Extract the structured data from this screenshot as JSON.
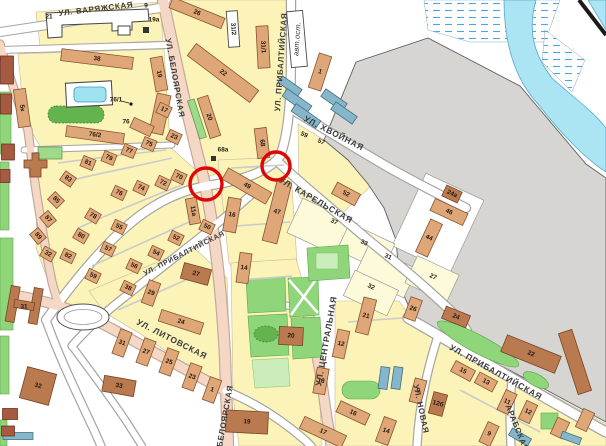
{
  "map": {
    "colors": {
      "block_yellow": "#FBF3B8",
      "quarter_pale": "#FCFAD9",
      "industrial_gray": "#D6D5D2",
      "water": "#ABE4F2",
      "marsh_dash": "#49A8DE",
      "road_main": "#F5D7C6",
      "building_tan": "#DFA678",
      "building_brown": "#B97A50",
      "building_blue": "#85B6CB",
      "green": "#8FD67B",
      "highlight_red": "#E00505"
    },
    "street_labels": [
      {
        "t": "УЛ. ВАРЯЖСКАЯ",
        "x": 96,
        "y": 9,
        "r": -7,
        "s": 8
      },
      {
        "t": "УЛ. БЕЛОЯРСКАЯ",
        "x": 175,
        "y": 78,
        "r": 80,
        "s": 8
      },
      {
        "t": "УЛ. ПРИБАЛТИЙСКАЯ",
        "x": 281,
        "y": 62,
        "r": -86,
        "s": 8
      },
      {
        "t": "авт.ост.",
        "x": 297,
        "y": 39,
        "r": -86,
        "s": 7.5,
        "i": true
      },
      {
        "t": "УЛ. ХВОЙНАЯ",
        "x": 334,
        "y": 133,
        "r": 27,
        "s": 8.5
      },
      {
        "t": "УЛ. КАРЕЛЬСКАЯ",
        "x": 316,
        "y": 200,
        "r": 30,
        "s": 8.5
      },
      {
        "t": "УЛ. ПРИБАЛТИЙСКАЯ",
        "x": 184,
        "y": 253,
        "r": -27,
        "s": 7.2
      },
      {
        "t": "УЛ. ЛИТОВСКАЯ",
        "x": 172,
        "y": 339,
        "r": 27,
        "s": 8.5
      },
      {
        "t": "УЛ. ЦЕНТРАЛЬНАЯ",
        "x": 326,
        "y": 341,
        "r": -80,
        "s": 8.5
      },
      {
        "t": "БЕЛОЯРСКАЯ",
        "x": 225,
        "y": 416,
        "r": -80,
        "s": 8
      },
      {
        "t": "УЛ. НОВАЯ",
        "x": 421,
        "y": 409,
        "r": 78,
        "s": 8
      },
      {
        "t": "АРАБСКАЯ",
        "x": 517,
        "y": 428,
        "r": 68,
        "s": 8
      },
      {
        "t": "УЛ. ПРИБАЛТИЙСКАЯ",
        "x": 496,
        "y": 372,
        "r": 29,
        "s": 8.5
      }
    ],
    "buildings": [
      {
        "t": "21",
        "x": 49,
        "y": 17
      },
      {
        "t": "9",
        "x": 146,
        "y": 6
      },
      {
        "t": "19а",
        "x": 154,
        "y": 20
      },
      {
        "t": "26",
        "x": 197,
        "y": 13,
        "w": 56,
        "h": 11,
        "r": 22,
        "c": "t"
      },
      {
        "t": "31/2",
        "x": 233,
        "y": 29,
        "w": 36,
        "h": 11,
        "r": 86,
        "c": "w"
      },
      {
        "t": "31/1",
        "x": 263,
        "y": 47,
        "w": 42,
        "h": 12,
        "r": 87,
        "c": "t"
      },
      {
        "t": "22",
        "x": 223,
        "y": 73,
        "w": 78,
        "h": 15,
        "r": 37,
        "c": "t"
      },
      {
        "t": "19",
        "x": 159,
        "y": 74,
        "w": 34,
        "h": 12,
        "r": 80,
        "c": "t"
      },
      {
        "t": "",
        "x": 197,
        "y": 119,
        "w": 40,
        "h": 7,
        "r": 72,
        "c": "g"
      },
      {
        "t": "20",
        "x": 209,
        "y": 117,
        "w": 42,
        "h": 11,
        "r": 72,
        "c": "t"
      },
      {
        "t": "68",
        "x": 262,
        "y": 143,
        "w": 30,
        "h": 12,
        "r": 83,
        "c": "t"
      },
      {
        "t": "68а",
        "x": 223,
        "y": 150
      },
      {
        "t": "38",
        "x": 97,
        "y": 59,
        "w": 72,
        "h": 12,
        "r": 7,
        "c": "t"
      },
      {
        "t": "",
        "x": 160,
        "y": 114,
        "w": 14,
        "h": 40,
        "r": 12,
        "c": "t"
      },
      {
        "t": "76/1",
        "x": 116,
        "y": 100
      },
      {
        "t": "",
        "x": 142,
        "y": 127,
        "w": 22,
        "h": 11,
        "r": 25,
        "c": "t"
      },
      {
        "t": "76",
        "x": 126,
        "y": 122
      },
      {
        "t": "76/2",
        "x": 95,
        "y": 135,
        "w": 58,
        "h": 11,
        "r": 8,
        "c": "t"
      },
      {
        "t": "5к",
        "x": 22,
        "y": 108,
        "w": 38,
        "h": 12,
        "r": 82,
        "c": "t"
      },
      {
        "t": "17",
        "x": 164,
        "y": 110,
        "w": 13,
        "h": 11,
        "r": 25,
        "c": "t"
      },
      {
        "t": "23",
        "x": 174,
        "y": 137,
        "w": 13,
        "h": 11,
        "r": 25,
        "c": "t"
      },
      {
        "t": "75",
        "x": 149,
        "y": 144,
        "w": 13,
        "h": 11,
        "r": 22,
        "c": "t"
      },
      {
        "t": "77",
        "x": 129,
        "y": 151,
        "w": 13,
        "h": 11,
        "r": 22,
        "c": "t"
      },
      {
        "t": "79",
        "x": 109,
        "y": 158,
        "w": 13,
        "h": 11,
        "r": 22,
        "c": "t"
      },
      {
        "t": "81",
        "x": 88,
        "y": 163,
        "w": 13,
        "h": 11,
        "r": 22,
        "c": "t"
      },
      {
        "t": "83",
        "x": 68,
        "y": 179,
        "w": 13,
        "h": 11,
        "r": 35,
        "c": "t"
      },
      {
        "t": "85",
        "x": 56,
        "y": 200,
        "w": 13,
        "h": 11,
        "r": 45,
        "c": "t"
      },
      {
        "t": "87",
        "x": 48,
        "y": 219,
        "w": 13,
        "h": 11,
        "r": 50,
        "c": "t"
      },
      {
        "t": "89",
        "x": 38,
        "y": 236,
        "w": 13,
        "h": 11,
        "r": 50,
        "c": "t"
      },
      {
        "t": "32",
        "x": 48,
        "y": 254,
        "w": 13,
        "h": 11,
        "r": 30,
        "c": "t"
      },
      {
        "t": "82",
        "x": 68,
        "y": 256,
        "w": 13,
        "h": 11,
        "r": 25,
        "c": "t"
      },
      {
        "t": "80",
        "x": 81,
        "y": 236,
        "w": 13,
        "h": 11,
        "r": 30,
        "c": "t"
      },
      {
        "t": "78",
        "x": 93,
        "y": 216,
        "w": 13,
        "h": 11,
        "r": 30,
        "c": "t"
      },
      {
        "t": "76",
        "x": 119,
        "y": 193,
        "w": 13,
        "h": 11,
        "r": 25,
        "c": "t"
      },
      {
        "t": "74",
        "x": 141,
        "y": 188,
        "w": 13,
        "h": 11,
        "r": 25,
        "c": "t"
      },
      {
        "t": "72",
        "x": 163,
        "y": 183,
        "w": 13,
        "h": 11,
        "r": 25,
        "c": "t"
      },
      {
        "t": "70",
        "x": 179,
        "y": 177,
        "w": 13,
        "h": 11,
        "r": 25,
        "c": "t"
      },
      {
        "t": "59",
        "x": 93,
        "y": 276,
        "w": 13,
        "h": 11,
        "r": 25,
        "c": "t"
      },
      {
        "t": "57",
        "x": 108,
        "y": 249,
        "w": 13,
        "h": 11,
        "r": 25,
        "c": "t"
      },
      {
        "t": "55",
        "x": 119,
        "y": 227,
        "w": 13,
        "h": 11,
        "r": 25,
        "c": "t"
      },
      {
        "t": "56",
        "x": 134,
        "y": 266,
        "w": 13,
        "h": 11,
        "r": 25,
        "c": "t"
      },
      {
        "t": "54",
        "x": 156,
        "y": 253,
        "w": 13,
        "h": 11,
        "r": 25,
        "c": "t"
      },
      {
        "t": "52",
        "x": 176,
        "y": 238,
        "w": 13,
        "h": 11,
        "r": 25,
        "c": "t"
      },
      {
        "t": "50",
        "x": 207,
        "y": 227,
        "w": 13,
        "h": 11,
        "r": 25,
        "c": "t"
      },
      {
        "t": "11а",
        "x": 193,
        "y": 211,
        "w": 26,
        "h": 11,
        "r": 80,
        "c": "t"
      },
      {
        "t": "27",
        "x": 196,
        "y": 274,
        "w": 28,
        "h": 16,
        "r": 15,
        "c": "b"
      },
      {
        "t": "38",
        "x": 128,
        "y": 288,
        "w": 13,
        "h": 11,
        "r": 25,
        "c": "t"
      },
      {
        "t": "49",
        "x": 247,
        "y": 186,
        "w": 50,
        "h": 13,
        "r": 30,
        "c": "t"
      },
      {
        "t": "16",
        "x": 232,
        "y": 215,
        "w": 13,
        "h": 34,
        "r": 10,
        "c": "t"
      },
      {
        "t": "47",
        "x": 277,
        "y": 212,
        "w": 15,
        "h": 62,
        "r": 14,
        "c": "t"
      },
      {
        "t": "14",
        "x": 244,
        "y": 268,
        "w": 12,
        "h": 30,
        "r": 8,
        "c": "t"
      },
      {
        "t": "52",
        "x": 346,
        "y": 194,
        "w": 26,
        "h": 13,
        "r": 28,
        "c": "t"
      },
      {
        "t": "24а",
        "x": 452,
        "y": 194,
        "w": 17,
        "h": 12,
        "r": 25,
        "c": "b"
      },
      {
        "t": "46",
        "x": 449,
        "y": 212,
        "w": 36,
        "h": 13,
        "r": 25,
        "c": "t"
      },
      {
        "t": "44",
        "x": 429,
        "y": 238,
        "w": 13,
        "h": 36,
        "r": 25,
        "c": "t"
      },
      {
        "t": "1",
        "x": 320,
        "y": 72,
        "w": 13,
        "h": 36,
        "r": 18,
        "c": "t"
      },
      {
        "t": "59",
        "x": 304,
        "y": 135,
        "lr": 25
      },
      {
        "t": "57",
        "x": 321,
        "y": 142,
        "lr": 25
      },
      {
        "t": "37",
        "x": 334,
        "y": 222,
        "lr": 25
      },
      {
        "t": "33",
        "x": 364,
        "y": 243,
        "lr": 25
      },
      {
        "t": "31",
        "x": 388,
        "y": 257,
        "lr": 25
      },
      {
        "t": "27",
        "x": 433,
        "y": 277,
        "lr": 25
      },
      {
        "t": "32",
        "x": 371,
        "y": 287,
        "lr": 25
      },
      {
        "t": "20",
        "x": 291,
        "y": 336,
        "w": 24,
        "h": 18,
        "r": 3,
        "c": "b"
      },
      {
        "t": "21",
        "x": 366,
        "y": 316,
        "w": 13,
        "h": 36,
        "r": 14,
        "c": "t"
      },
      {
        "t": "12",
        "x": 341,
        "y": 344,
        "w": 12,
        "h": 28,
        "r": 12,
        "c": "t"
      },
      {
        "t": "18",
        "x": 321,
        "y": 381,
        "w": 12,
        "h": 26,
        "r": 10,
        "c": "t"
      },
      {
        "t": "16",
        "x": 353,
        "y": 413,
        "w": 32,
        "h": 12,
        "r": 25,
        "c": "t"
      },
      {
        "t": "17",
        "x": 323,
        "y": 432,
        "w": 46,
        "h": 13,
        "r": 25,
        "c": "t"
      },
      {
        "t": "14",
        "x": 386,
        "y": 431,
        "w": 13,
        "h": 26,
        "r": 20,
        "c": "t"
      },
      {
        "t": "9",
        "x": 418,
        "y": 391,
        "w": 12,
        "h": 24,
        "r": 15,
        "c": "t"
      },
      {
        "t": "12б",
        "x": 438,
        "y": 404,
        "w": 14,
        "h": 22,
        "r": 15,
        "c": "b"
      },
      {
        "t": "26",
        "x": 413,
        "y": 309,
        "w": 12,
        "h": 22,
        "r": 20,
        "c": "t"
      },
      {
        "t": "24",
        "x": 456,
        "y": 317,
        "w": 26,
        "h": 13,
        "r": 22,
        "c": "b"
      },
      {
        "t": "22",
        "x": 531,
        "y": 354,
        "w": 58,
        "h": 18,
        "r": 22,
        "c": "b"
      },
      {
        "t": "",
        "x": 575,
        "y": 362,
        "w": 64,
        "h": 14,
        "r": 72,
        "c": "b"
      },
      {
        "t": "15",
        "x": 463,
        "y": 371,
        "w": 22,
        "h": 12,
        "r": 28,
        "c": "t"
      },
      {
        "t": "13",
        "x": 486,
        "y": 382,
        "w": 20,
        "h": 12,
        "r": 28,
        "c": "t"
      },
      {
        "t": "11",
        "x": 507,
        "y": 402,
        "w": 12,
        "h": 22,
        "r": 25,
        "c": "t"
      },
      {
        "t": "12",
        "x": 528,
        "y": 412,
        "w": 12,
        "h": 20,
        "r": 25,
        "c": "t"
      },
      {
        "t": "9",
        "x": 489,
        "y": 434,
        "w": 12,
        "h": 22,
        "r": 25,
        "c": "t"
      },
      {
        "t": "",
        "x": 560,
        "y": 428,
        "w": 13,
        "h": 18,
        "r": 25,
        "c": "t"
      },
      {
        "t": "",
        "x": 585,
        "y": 420,
        "w": 12,
        "h": 20,
        "r": 25,
        "c": "t"
      },
      {
        "t": "",
        "x": 571,
        "y": 438,
        "w": 20,
        "h": 7,
        "r": 20,
        "c": "u"
      },
      {
        "t": "19",
        "x": 247,
        "y": 422,
        "w": 42,
        "h": 22,
        "r": 3,
        "c": "b"
      },
      {
        "t": "33",
        "x": 119,
        "y": 386,
        "w": 32,
        "h": 16,
        "r": 10,
        "c": "b"
      },
      {
        "t": "32",
        "x": 38,
        "y": 386,
        "w": 30,
        "h": 32,
        "r": 15,
        "c": "b"
      },
      {
        "t": "31",
        "x": 24,
        "y": 307
      },
      {
        "t": "24",
        "x": 181,
        "y": 322,
        "w": 44,
        "h": 12,
        "r": 18,
        "c": "t"
      },
      {
        "t": "31",
        "x": 122,
        "y": 343,
        "w": 12,
        "h": 26,
        "r": 20,
        "c": "t"
      },
      {
        "t": "27",
        "x": 146,
        "y": 352,
        "w": 12,
        "h": 26,
        "r": 20,
        "c": "t"
      },
      {
        "t": "25",
        "x": 169,
        "y": 362,
        "w": 12,
        "h": 26,
        "r": 20,
        "c": "t"
      },
      {
        "t": "23",
        "x": 192,
        "y": 377,
        "w": 12,
        "h": 26,
        "r": 20,
        "c": "t"
      },
      {
        "t": "1",
        "x": 212,
        "y": 390,
        "w": 12,
        "h": 24,
        "r": 20,
        "c": "t"
      },
      {
        "t": "29",
        "x": 151,
        "y": 293,
        "w": 12,
        "h": 24,
        "r": 20,
        "c": "t"
      },
      {
        "t": "",
        "x": 290,
        "y": 86,
        "w": 24,
        "h": 8,
        "r": 35,
        "c": "u"
      },
      {
        "t": "",
        "x": 297,
        "y": 101,
        "w": 30,
        "h": 9,
        "r": 35,
        "c": "u"
      },
      {
        "t": "",
        "x": 306,
        "y": 116,
        "w": 30,
        "h": 9,
        "r": 35,
        "c": "u"
      },
      {
        "t": "",
        "x": 334,
        "y": 100,
        "w": 26,
        "h": 9,
        "r": 35,
        "c": "u"
      },
      {
        "t": "",
        "x": 344,
        "y": 113,
        "w": 26,
        "h": 9,
        "r": 35,
        "c": "u"
      },
      {
        "t": "",
        "x": 384,
        "y": 378,
        "w": 9,
        "h": 22,
        "r": 8,
        "c": "u"
      },
      {
        "t": "",
        "x": 397,
        "y": 378,
        "w": 9,
        "h": 22,
        "r": 8,
        "c": "u"
      },
      {
        "t": "",
        "x": 520,
        "y": 437,
        "w": 22,
        "h": 8,
        "r": 30,
        "c": "u"
      },
      {
        "t": "",
        "x": 18,
        "y": 436,
        "w": 30,
        "h": 7,
        "r": 0,
        "c": "u"
      },
      {
        "t": "",
        "x": 7,
        "y": 70,
        "w": 13,
        "h": 28,
        "r": 0,
        "c": "d"
      },
      {
        "t": "",
        "x": 6,
        "y": 104,
        "w": 11,
        "h": 20,
        "r": 0,
        "c": "d"
      },
      {
        "t": "",
        "x": 8,
        "y": 152,
        "w": 13,
        "h": 16,
        "r": 0,
        "c": "d"
      },
      {
        "t": "",
        "x": 5,
        "y": 176,
        "w": 10,
        "h": 13,
        "r": 0,
        "c": "d"
      },
      {
        "t": "",
        "x": 10,
        "y": 414,
        "w": 15,
        "h": 11,
        "r": 0,
        "c": "d"
      },
      {
        "t": "",
        "x": 8,
        "y": 431,
        "w": 13,
        "h": 10,
        "r": 0,
        "c": "d"
      },
      {
        "t": "",
        "x": 297,
        "y": 39,
        "w": 16,
        "h": 56,
        "r": -5,
        "c": "w"
      }
    ],
    "icons": [
      {
        "k": "monument-icon",
        "x": 143,
        "y": 27,
        "s": 6
      },
      {
        "k": "monument-icon",
        "x": 211,
        "y": 156,
        "s": 5
      },
      {
        "k": "address-dot",
        "x": 131,
        "y": 104,
        "s": 1.6
      }
    ],
    "markers": {
      "color": "#E00505",
      "circles": [
        {
          "x": 206,
          "y": 184,
          "r": 16
        },
        {
          "x": 276,
          "y": 166,
          "r": 14
        }
      ]
    }
  }
}
